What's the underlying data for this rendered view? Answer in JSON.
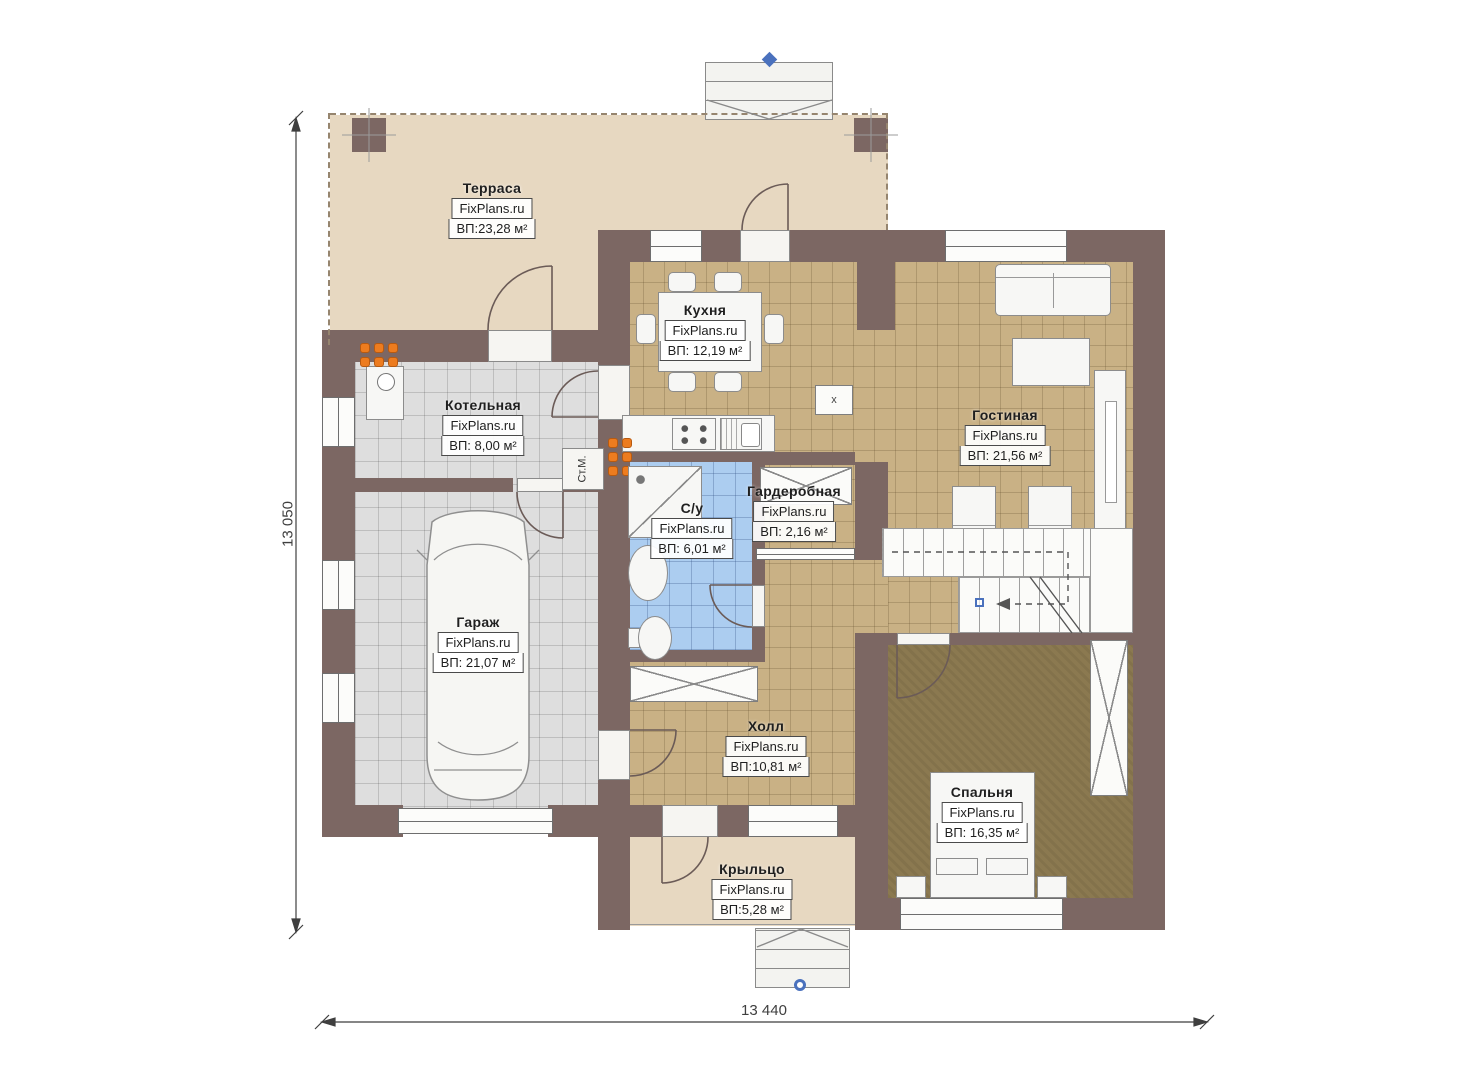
{
  "plan": {
    "brand": "FixPlans.ru",
    "rooms": {
      "terrace": {
        "name": "Терраса",
        "area": "ВП:23,28 м²"
      },
      "kitchen": {
        "name": "Кухня",
        "area": "ВП: 12,19 м²"
      },
      "boiler": {
        "name": "Котельная",
        "area": "ВП: 8,00 м²"
      },
      "living": {
        "name": "Гостиная",
        "area": "ВП: 21,56 м²"
      },
      "dressing": {
        "name": "Гардеробная",
        "area": "ВП: 2,16 м²"
      },
      "bathroom": {
        "name": "С/у",
        "area": "ВП: 6,01 м²"
      },
      "garage": {
        "name": "Гараж",
        "area": "ВП: 21,07 м²"
      },
      "hall": {
        "name": "Холл",
        "area": "ВП:10,81 м²"
      },
      "bedroom": {
        "name": "Спальня",
        "area": "ВП: 16,35 м²"
      },
      "porch": {
        "name": "Крыльцо",
        "area": "ВП:5,28 м²"
      }
    },
    "labels": {
      "washing_machine": "Ст.М.",
      "vent": "х"
    },
    "dimensions": {
      "bottom_width": "13 440",
      "left_height": "13 050"
    }
  },
  "colors": {
    "wall": "#7c6763",
    "wall_edge": "#5e4f4b",
    "floor_terrace": "#e7d8c1",
    "floor_tile_tan": "#c9b185",
    "floor_tile_gray": "#dedede",
    "floor_tile_blue": "#accdf0",
    "floor_bedroom": "#8b7950",
    "furniture_fill": "#f7f7f5",
    "furniture_line": "#8c8c8c",
    "radiator_orange": "#ed7c1f",
    "marker_blue": "#4a71bd",
    "dimension_line": "#3f3f3f",
    "label_border": "#4a4a4a",
    "label_text": "#1f1f1f"
  }
}
